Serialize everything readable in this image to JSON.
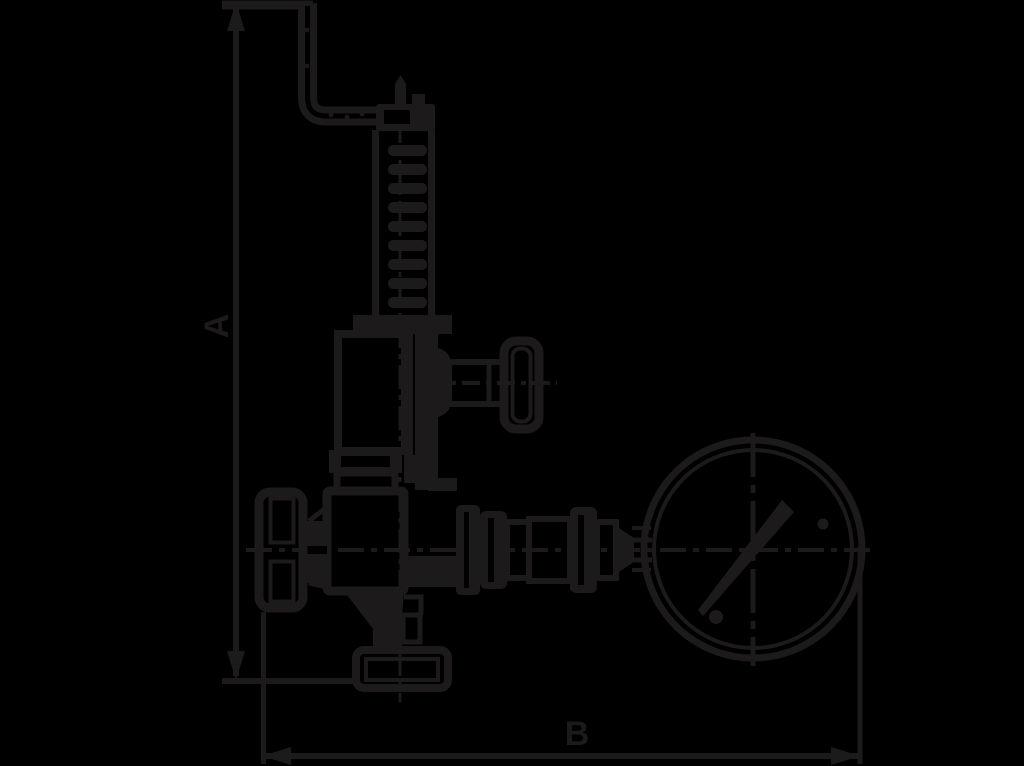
{
  "diagram": {
    "type": "technical-drawing",
    "subject": "angle safety valve with lift lever and pressure gauge, dimensioned outline drawing",
    "background_color": "#000000",
    "ink_color": "#1c1a1b",
    "dimensions": {
      "vertical": {
        "label": "A"
      },
      "horizontal": {
        "label": "B"
      }
    }
  }
}
